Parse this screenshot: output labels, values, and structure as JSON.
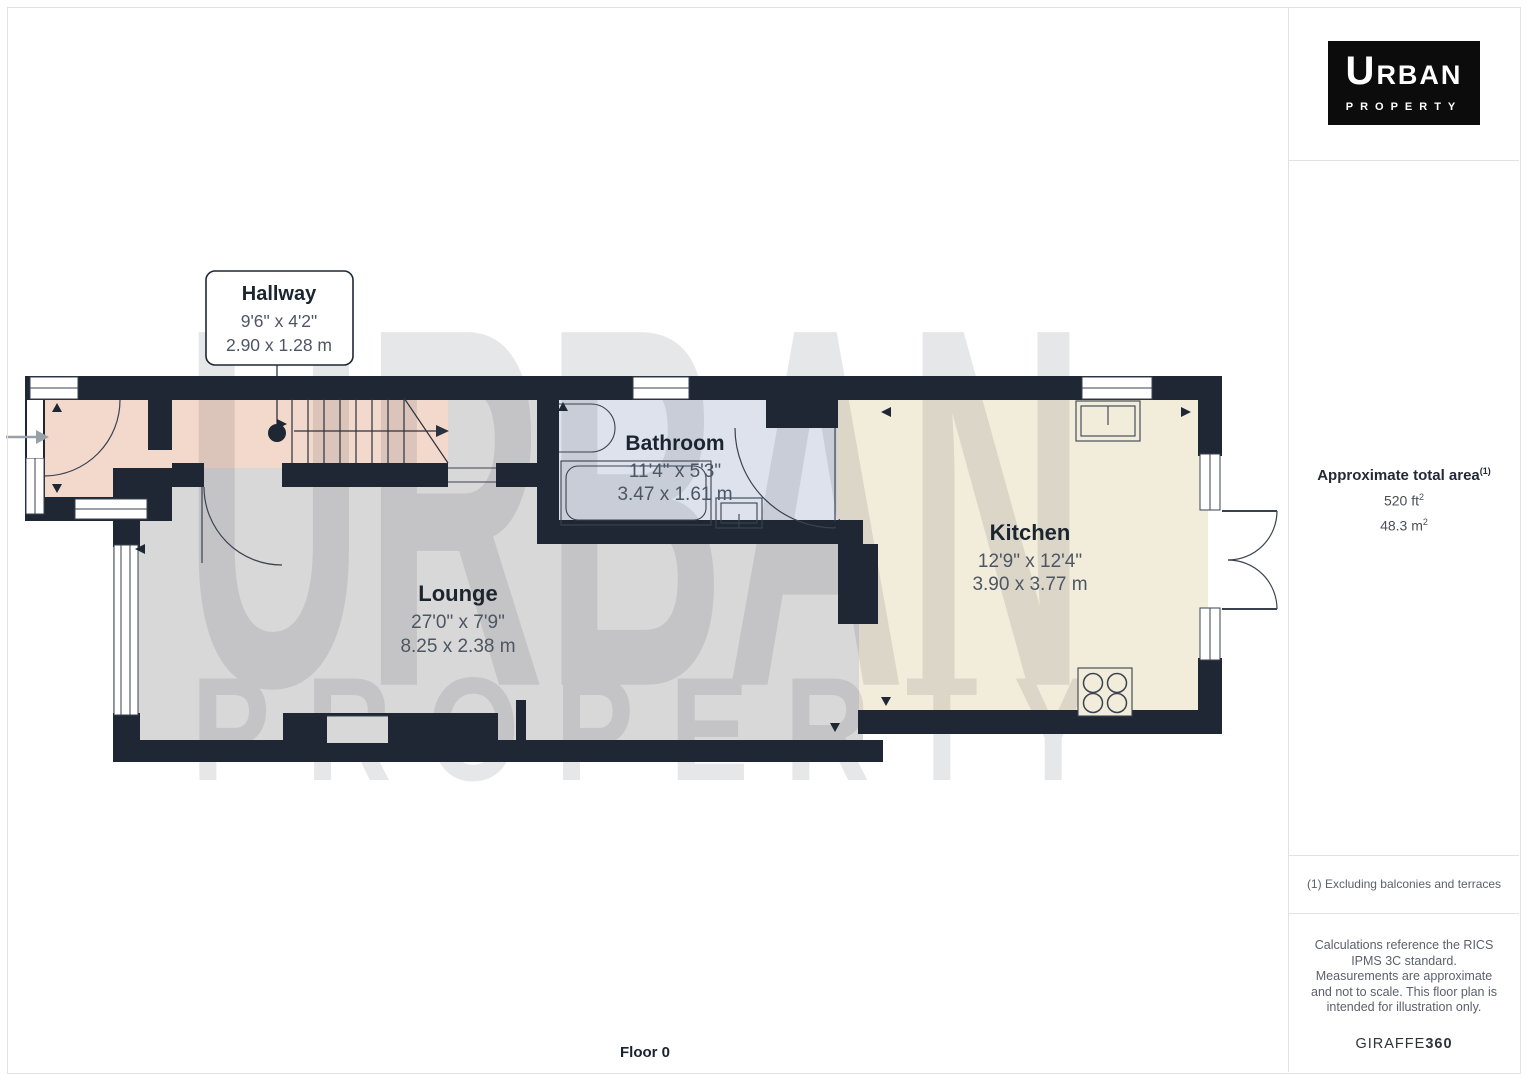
{
  "plan": {
    "floor_label": "Floor 0",
    "watermark": {
      "line1": "URBAN",
      "line2": "PROPERTY"
    },
    "rooms": {
      "hallway": {
        "name": "Hallway",
        "imperial": "9'6\" x 4'2\"",
        "metric": "2.90 x 1.28 m"
      },
      "bathroom": {
        "name": "Bathroom",
        "imperial": "11'4\" x 5'3\"",
        "metric": "3.47 x 1.61 m"
      },
      "lounge": {
        "name": "Lounge",
        "imperial": "27'0\" x 7'9\"",
        "metric": "8.25 x 2.38 m"
      },
      "kitchen": {
        "name": "Kitchen",
        "imperial": "12'9\" x 12'4\"",
        "metric": "3.90 x 3.77 m"
      }
    }
  },
  "sidebar": {
    "logo": {
      "line1_cap": "U",
      "line1_rest": "RBAN",
      "line2": "PROPERTY"
    },
    "area": {
      "title": "Approximate total area",
      "footnote_marker": "(1)",
      "ft_value": "520 ft",
      "ft_sup": "2",
      "m_value": "48.3 m",
      "m_sup": "2"
    },
    "footnote1": "(1) Excluding balconies and terraces",
    "disclaimer": "Calculations reference the RICS IPMS 3C standard. Measurements are approximate and not to scale. This floor plan is intended for illustration only.",
    "brand_name": "GIRAFFE",
    "brand_suffix": "360"
  },
  "colors": {
    "wall": "#1e2733",
    "hallway": "#f2d9cb",
    "lounge": "#d8d8d8",
    "bathroom": "#dde2ed",
    "kitchen": "#f2ecdb"
  }
}
